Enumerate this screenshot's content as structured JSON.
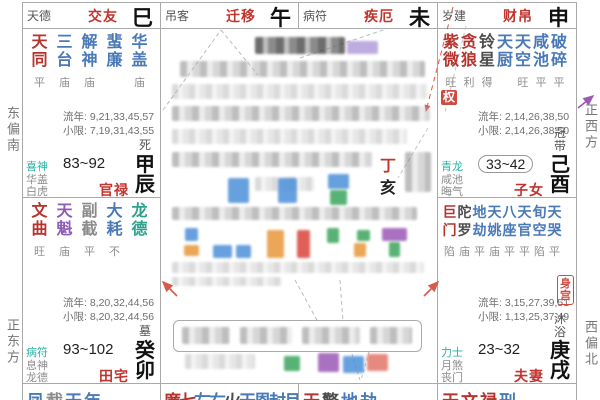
{
  "margins": {
    "left_top": "东偏南",
    "left_bottom": "正东方",
    "right_top": "正西方",
    "right_bottom": "西偏北"
  },
  "top_strip": [
    {
      "shensha": "天德",
      "palace": "交友",
      "branch": "巳"
    },
    {
      "shensha": "吊客",
      "palace": "迁移",
      "branch": "午"
    },
    {
      "shensha": "病符",
      "palace": "疾厄",
      "branch": "未"
    },
    {
      "shensha": "岁建",
      "palace": "财帛",
      "branch": "申"
    }
  ],
  "palaces": [
    {
      "id": "guanlu",
      "side": "left",
      "row": "A",
      "stars": [
        {
          "t": "天同",
          "c": "red",
          "b": "平"
        },
        {
          "t": "三台",
          "c": "blue",
          "b": "庙"
        },
        {
          "t": "解神",
          "c": "blue",
          "b": "庙"
        },
        {
          "t": "蜚廉",
          "c": "blue",
          "b": ""
        },
        {
          "t": "华盖",
          "c": "blue",
          "b": "庙"
        }
      ],
      "liunian": "流年: 9,21,33,45,57",
      "xiaoxian": "小限: 7,19,31,43,55",
      "stage": "死",
      "shensha": [
        "喜神",
        "华盖",
        "白虎"
      ],
      "age": "83~92",
      "age_boxed": false,
      "name": "官禄",
      "ganzhi": "甲辰",
      "hua": null,
      "body_palace": false
    },
    {
      "id": "zinv",
      "side": "right",
      "row": "A",
      "stars": [
        {
          "t": "紫微",
          "c": "red",
          "b": "旺"
        },
        {
          "t": "贪狼",
          "c": "red",
          "b": "利"
        },
        {
          "t": "铃星",
          "c": "dark",
          "b": "得"
        },
        {
          "t": "天厨",
          "c": "blue",
          "b": ""
        },
        {
          "t": "天空",
          "c": "blue",
          "b": "旺"
        },
        {
          "t": "咸池",
          "c": "blue",
          "b": "平"
        },
        {
          "t": "破碎",
          "c": "blue",
          "b": "平"
        }
      ],
      "liunian": "流年: 2,14,26,38,50",
      "xiaoxian": "小限: 2,14,26,38,50",
      "stage": "冠带",
      "shensha": [
        "青龙",
        "咸池",
        "晦气"
      ],
      "age": "33~42",
      "age_boxed": true,
      "name": "子女",
      "ganzhi": "己酉",
      "hua": "权",
      "body_palace": false
    },
    {
      "id": "tianzhai",
      "side": "left",
      "row": "B",
      "stars": [
        {
          "t": "文曲",
          "c": "red",
          "b": "旺"
        },
        {
          "t": "天魁",
          "c": "purple",
          "b": "庙"
        },
        {
          "t": "副截",
          "c": "gray",
          "b": "平"
        },
        {
          "t": "大耗",
          "c": "blue",
          "b": "不"
        },
        {
          "t": "龙德",
          "c": "teal",
          "b": ""
        }
      ],
      "liunian": "流年: 8,20,32,44,56",
      "xiaoxian": "小限: 8,20,32,44,56",
      "stage": "墓",
      "shensha": [
        "病符",
        "息神",
        "龙德"
      ],
      "age": "93~102",
      "age_boxed": false,
      "name": "田宅",
      "ganzhi": "癸卯",
      "hua": null,
      "body_palace": false
    },
    {
      "id": "fuqi",
      "side": "right",
      "row": "B",
      "stars": [
        {
          "t": "巨门",
          "c": "red",
          "b": "陷"
        },
        {
          "t": "陀罗",
          "c": "dark",
          "b": "庙"
        },
        {
          "t": "地劫",
          "c": "blue",
          "b": "平"
        },
        {
          "t": "天姚",
          "c": "blue",
          "b": "庙"
        },
        {
          "t": "八座",
          "c": "blue",
          "b": "平"
        },
        {
          "t": "天官",
          "c": "blue",
          "b": "平"
        },
        {
          "t": "旬空",
          "c": "blue",
          "b": "陷"
        },
        {
          "t": "天哭",
          "c": "blue",
          "b": "平"
        }
      ],
      "liunian": "流年: 3,15,27,39,51",
      "xiaoxian": "小限: 1,13,25,37,49",
      "stage": "沐浴",
      "shensha": [
        "力士",
        "月煞",
        "丧门"
      ],
      "age": "23~32",
      "age_boxed": false,
      "name": "夫妻",
      "ganzhi": "庚戌",
      "hua": null,
      "body_palace": true
    }
  ],
  "bottom_strip": [
    {
      "chars": [
        {
          "t": "凤",
          "c": "blue"
        },
        {
          "t": "截",
          "c": "gray"
        },
        {
          "t": "天",
          "c": "blue"
        },
        {
          "t": "年",
          "c": "blue"
        }
      ]
    },
    {
      "chars": [
        {
          "t": "廉",
          "c": "red"
        },
        {
          "t": "七",
          "c": "red"
        },
        {
          "t": "左",
          "c": "blue"
        },
        {
          "t": "右",
          "c": "blue"
        },
        {
          "t": "火",
          "c": "dark"
        },
        {
          "t": "天",
          "c": "blue"
        },
        {
          "t": "恩",
          "c": "blue"
        },
        {
          "t": "封",
          "c": "blue"
        },
        {
          "t": "月",
          "c": "blue"
        }
      ]
    },
    {
      "chars": [
        {
          "t": "天",
          "c": "red"
        },
        {
          "t": "擎",
          "c": "dark"
        },
        {
          "t": "地",
          "c": "blue"
        },
        {
          "t": "劫",
          "c": "blue"
        }
      ]
    },
    {
      "chars": [
        {
          "t": "天",
          "c": "red"
        },
        {
          "t": "文",
          "c": "red"
        },
        {
          "t": "禄",
          "c": "red"
        },
        {
          "t": "刑",
          "c": "blue"
        }
      ]
    }
  ],
  "center": {
    "year_stem": "丁",
    "year_branch": "亥"
  },
  "colors": {
    "accent_red": "#c2342e",
    "star_blue": "#4a79b8",
    "shensha_teal": "#2ab3a3",
    "badge_red": "#cf4b3f",
    "purple": "#8e5bb5"
  }
}
